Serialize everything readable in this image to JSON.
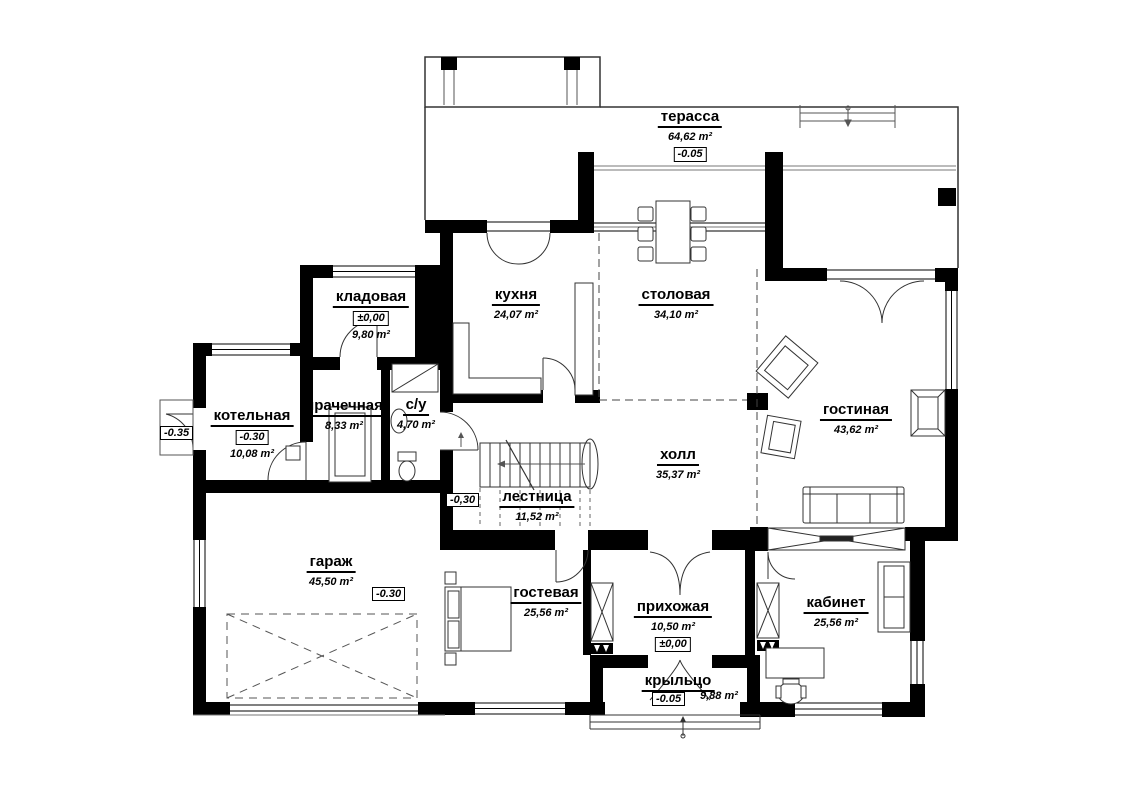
{
  "title": "first-floor-plan",
  "colors": {
    "wall": "#000000",
    "line": "#333333",
    "background": "#ffffff",
    "thin": "#777777"
  },
  "units": "m²",
  "rooms": {
    "terrace": {
      "name": "терасса",
      "area": "64,62 m²",
      "level": "-0.05"
    },
    "kladovaya": {
      "name": "кладовая",
      "area": "9,80 m²",
      "level": "±0,00"
    },
    "kuhnya": {
      "name": "кухня",
      "area": "24,07 m²"
    },
    "stolovaya": {
      "name": "столовая",
      "area": "34,10 m²"
    },
    "kotelnaya": {
      "name": "котельная",
      "area": "10,08 m²",
      "level": "-0.30"
    },
    "prachechnaya": {
      "name": "прачечная",
      "area": "8,33 m²"
    },
    "su": {
      "name": "с/у",
      "area": "4,70 m²"
    },
    "gostinaya": {
      "name": "гостиная",
      "area": "43,62 m²"
    },
    "holl": {
      "name": "холл",
      "area": "35,37 m²"
    },
    "lestnitsa": {
      "name": "лестница",
      "area": "11,52 m²",
      "level": "-0,30"
    },
    "garazh": {
      "name": "гараж",
      "area": "45,50 m²",
      "level": "-0.30"
    },
    "gostevaya": {
      "name": "гостевая",
      "area": "25,56 m²"
    },
    "prihozhaya": {
      "name": "прихожая",
      "area": "10,50 m²",
      "level": "±0,00"
    },
    "kabinet": {
      "name": "кабинет",
      "area": "25,56 m²"
    },
    "kryltso": {
      "name": "крыльцо",
      "area": "9,88 m²",
      "level": "-0.05"
    }
  },
  "markers": {
    "outside_level": "-0.35"
  }
}
